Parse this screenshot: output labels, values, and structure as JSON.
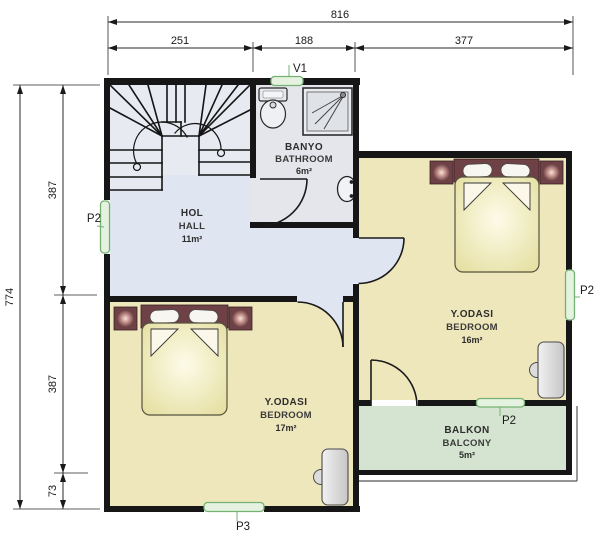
{
  "dimensions": {
    "top": {
      "total": "816",
      "segments": [
        "251",
        "188",
        "377"
      ]
    },
    "left": {
      "total": "774",
      "segments": [
        "387",
        "387",
        "73"
      ]
    }
  },
  "rooms": {
    "hall": {
      "name_tr": "HOL",
      "name_en": "HALL",
      "area": "11m²"
    },
    "bathroom": {
      "name_tr": "BANYO",
      "name_en": "BATHROOM",
      "area": "6m²"
    },
    "bedroom_right": {
      "name_tr": "Y.ODASI",
      "name_en": "BEDROOM",
      "area": "16m²"
    },
    "bedroom_left": {
      "name_tr": "Y.ODASI",
      "name_en": "BEDROOM",
      "area": "17m²"
    },
    "balcony": {
      "name_tr": "BALKON",
      "name_en": "BALCONY",
      "area": "5m²"
    }
  },
  "labels": {
    "vent_top": "V1",
    "door_left": "P2",
    "window_right": "P2",
    "door_balcony": "P2",
    "window_bottom": "P3"
  },
  "colors": {
    "wall": "#161616",
    "hall_floor": "#dfe5f1",
    "bathroom_floor": "#e4e6eb",
    "bedroom_floor": "#efe7bc",
    "balcony_floor": "#d5e4d0",
    "bed": "#e6e09f",
    "headboard": "#6d4145",
    "marker_green": "#74b274"
  }
}
